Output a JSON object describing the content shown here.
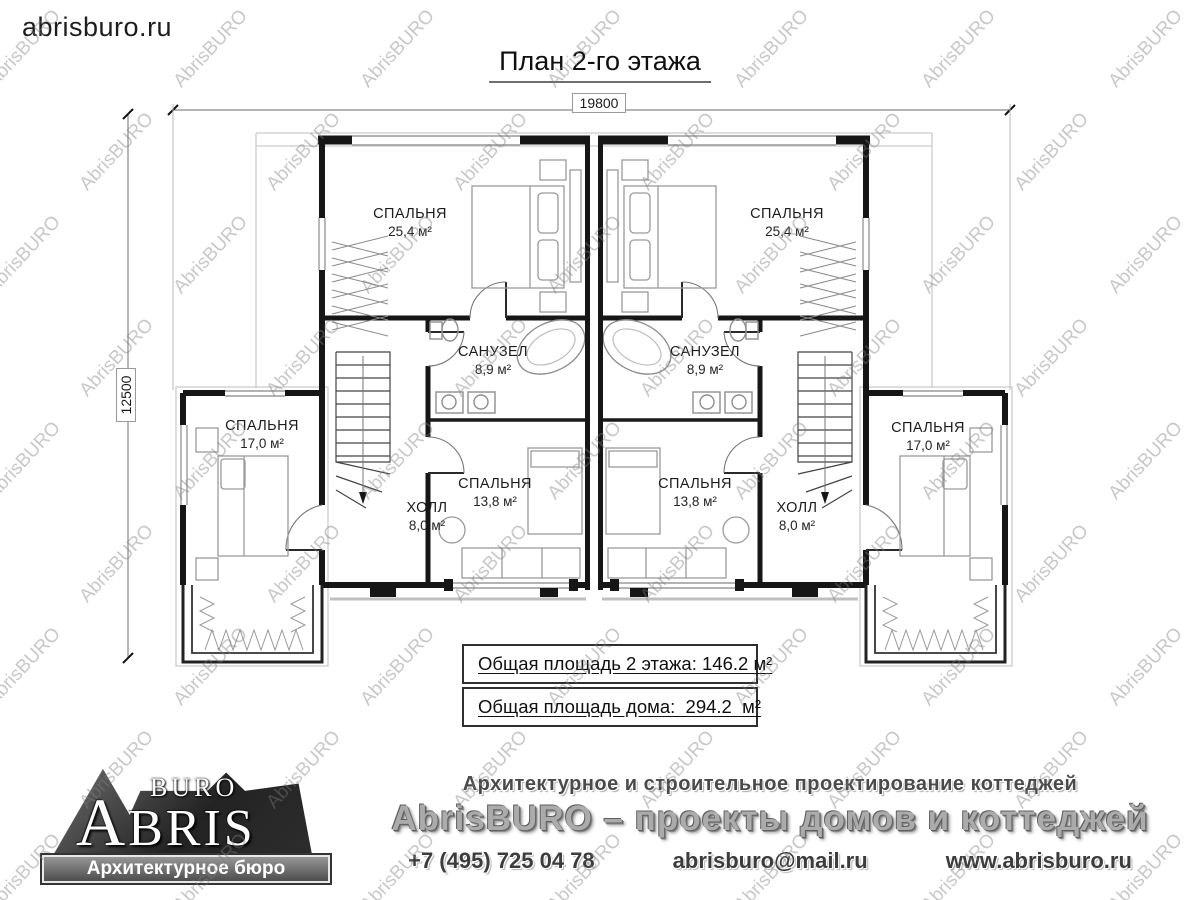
{
  "site_logo": "abrisburo.ru",
  "title": "План 2-го этажа",
  "watermark_text": "AbrisBURO",
  "dimensions": {
    "width": "19800",
    "height": "12500"
  },
  "rooms": [
    {
      "name": "СПАЛЬНЯ",
      "area": "25,4 м²"
    },
    {
      "name": "СПАЛЬНЯ",
      "area": "25,4 м²"
    },
    {
      "name": "САНУЗЕЛ",
      "area": "8,9 м²"
    },
    {
      "name": "САНУЗЕЛ",
      "area": "8,9 м²"
    },
    {
      "name": "СПАЛЬНЯ",
      "area": "17,0 м²"
    },
    {
      "name": "СПАЛЬНЯ",
      "area": "17,0 м²"
    },
    {
      "name": "ХОЛЛ",
      "area": "8,0 м²"
    },
    {
      "name": "ХОЛЛ",
      "area": "8,0 м²"
    },
    {
      "name": "СПАЛЬНЯ",
      "area": "13,8 м²"
    },
    {
      "name": "СПАЛЬНЯ",
      "area": "13,8 м²"
    }
  ],
  "summary": [
    {
      "text": "Общая площадь 2 этажа: 146.2 м²"
    },
    {
      "text": "Общая площадь дома:  294.2  м²"
    }
  ],
  "footer": {
    "logo": {
      "buro": "BURO",
      "abris": "ABRIS",
      "tagline": "Архитектурное бюро"
    },
    "line1": "Архитектурное и строительное проектирование коттеджей",
    "line2": "AbrisBURO – проекты домов и коттеджей",
    "contacts": {
      "phone": "+7 (495) 725 04 78",
      "email": "abrisburo@mail.ru",
      "site": "www.abrisburo.ru"
    }
  }
}
